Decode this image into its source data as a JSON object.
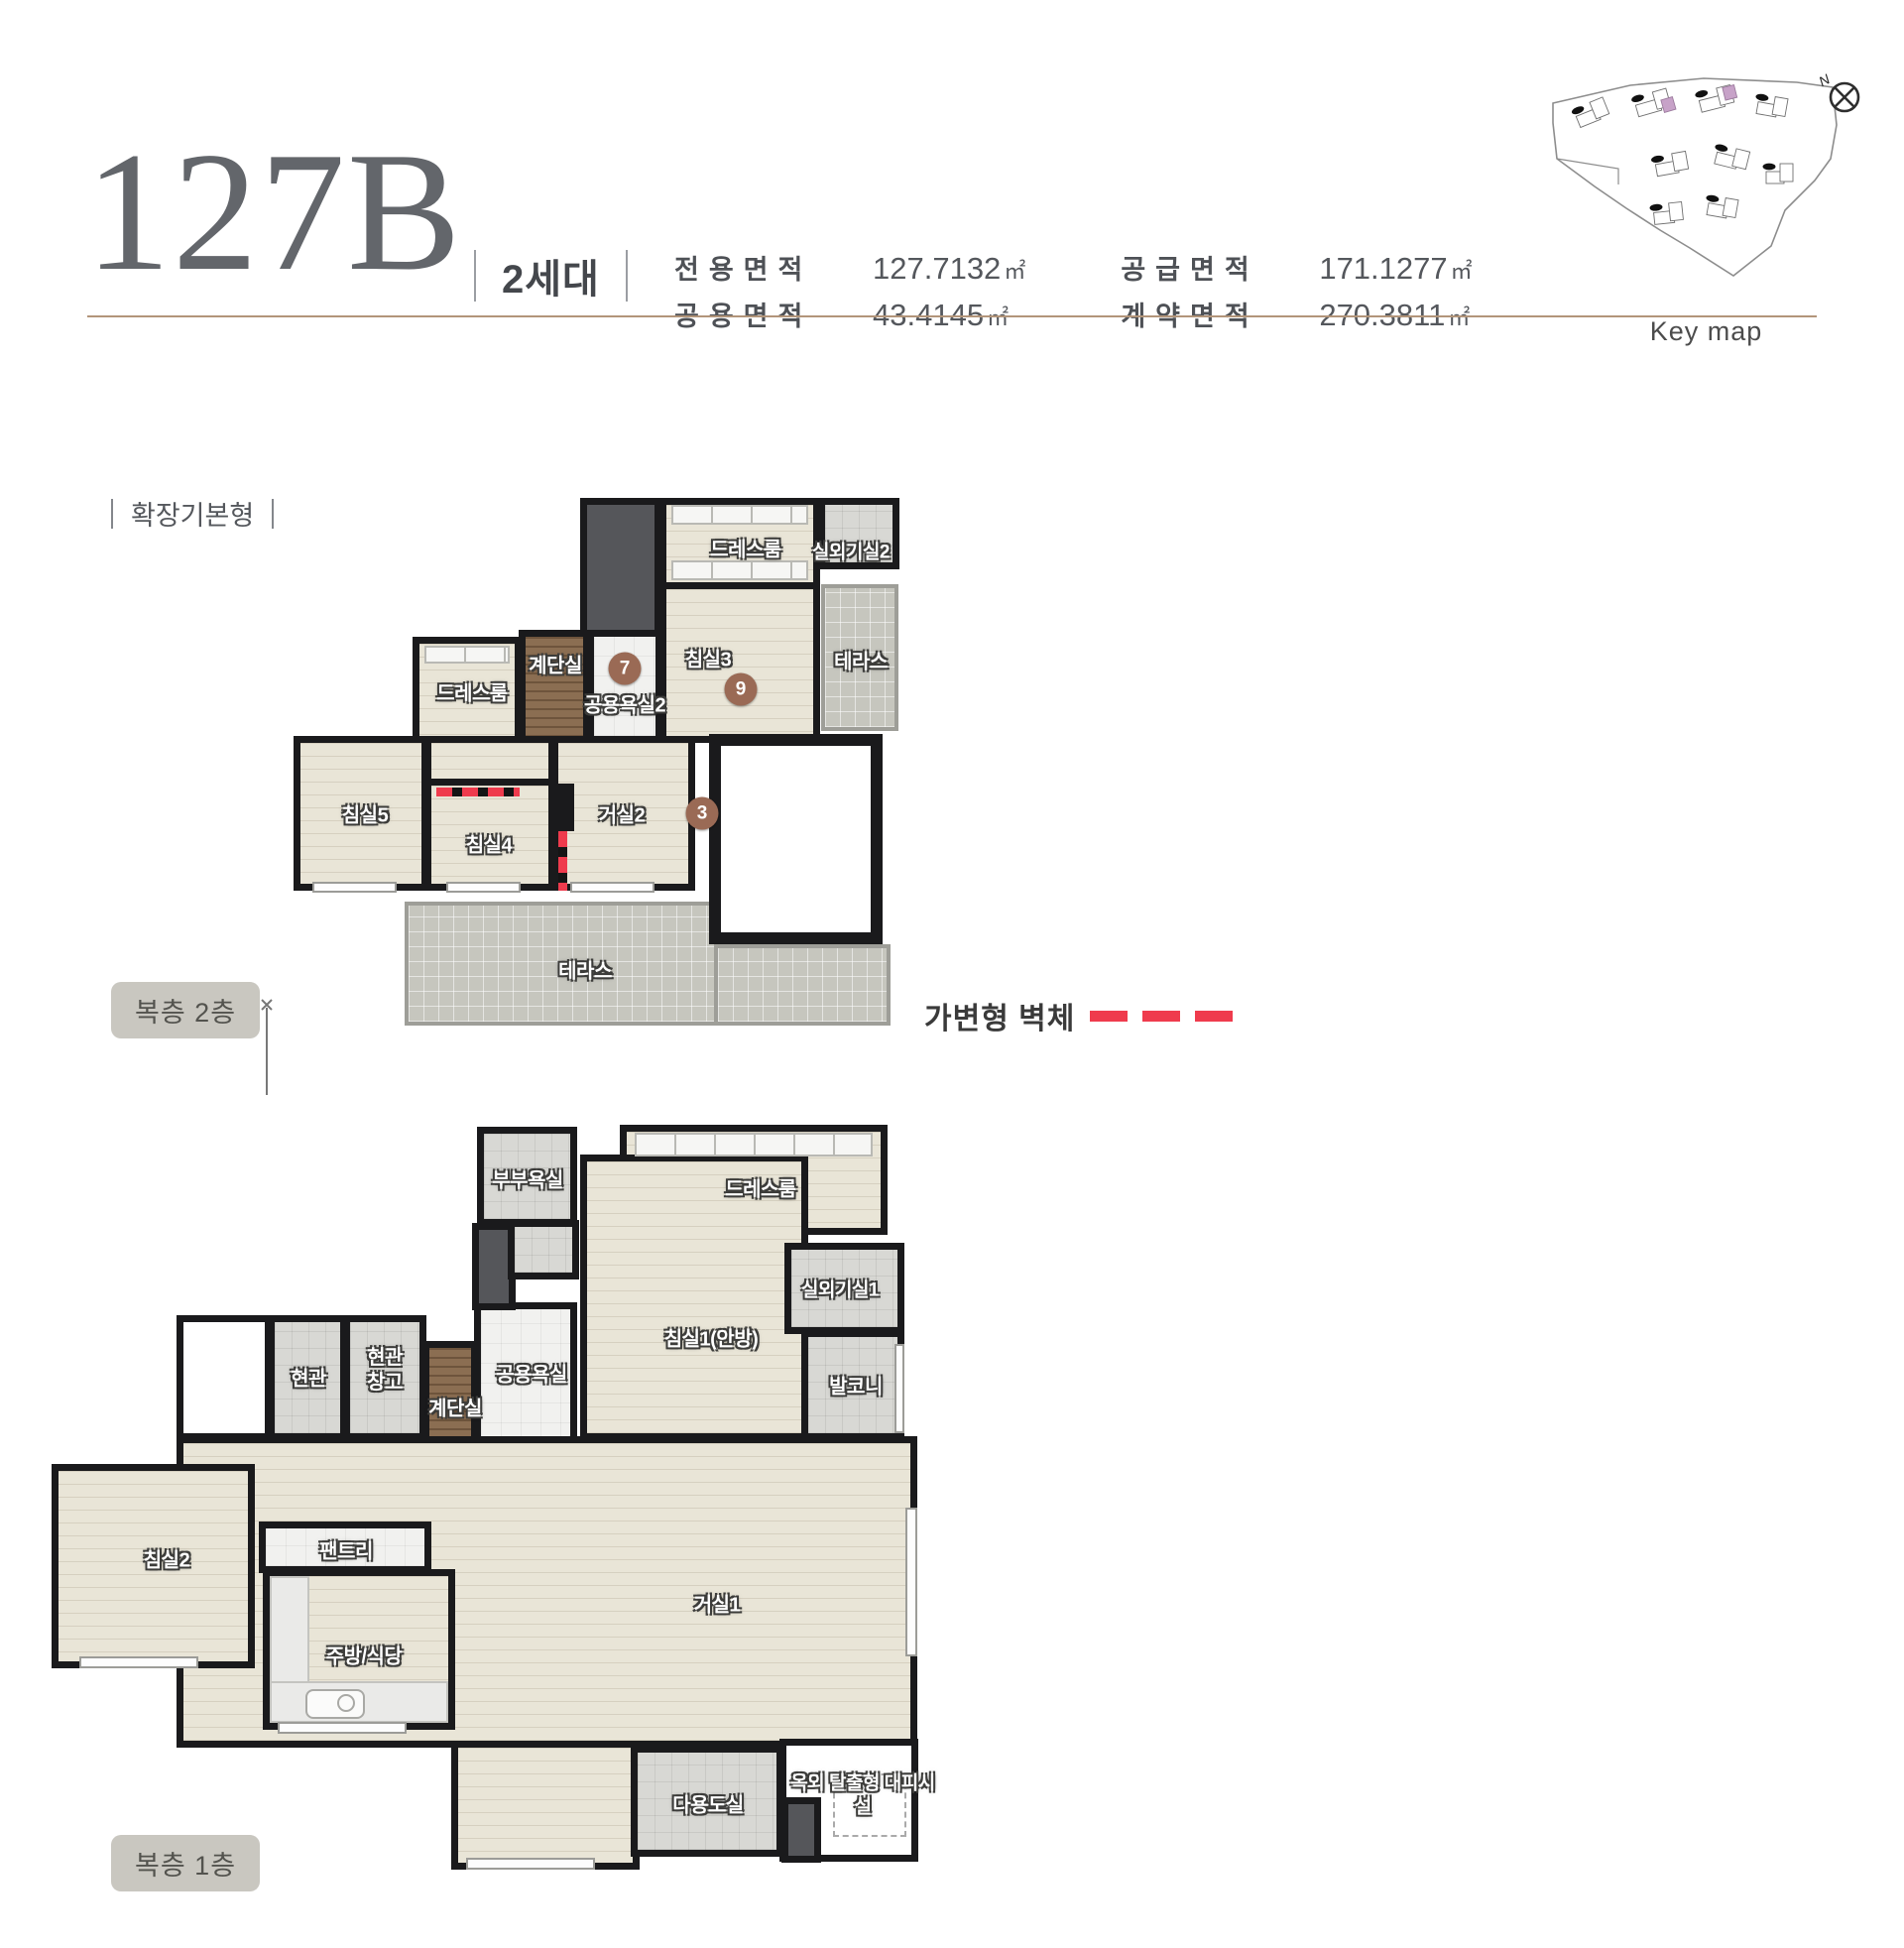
{
  "header": {
    "unit_code": "127B",
    "household_label": "2세대",
    "area_specs": [
      {
        "label": "전용면적",
        "value": "127.7132",
        "unit": "㎡"
      },
      {
        "label": "공용면적",
        "value": "43.4145",
        "unit": "㎡"
      },
      {
        "label": "공급면적",
        "value": "171.1277",
        "unit": "㎡"
      },
      {
        "label": "계약면적",
        "value": "270.3811",
        "unit": "㎡"
      }
    ],
    "keymap": {
      "caption": "Key map",
      "compass_n": "N"
    }
  },
  "section": {
    "plan_type_label": "확장기본형"
  },
  "legend": {
    "movable_wall_label": "가변형 벽체"
  },
  "colors": {
    "accent_line": "#b2957a",
    "movable_wall_red": "#ef3b4d",
    "marker_brown": "#9a6a55",
    "keymap_highlight": "#c7a2c8"
  },
  "floor2": {
    "badge": "복층 2층",
    "rooms": {
      "dressroom_top": "드레스룸",
      "outdoor_unit2": "실외기실2",
      "terrace_right": "테라스",
      "stairwell": "계단실",
      "shared_bath2": "공용욕실2",
      "bedroom3": "침실3",
      "dressroom_left": "드레스룸",
      "bedroom5": "침실5",
      "bedroom4": "침실4",
      "living2": "거실2",
      "terrace_bottom": "테라스"
    },
    "markers": {
      "shared_bath2": "7",
      "bedroom3": "9",
      "living2": "3"
    }
  },
  "floor1": {
    "badge": "복층 1층",
    "rooms": {
      "master_bath": "부부욕실",
      "dressroom": "드레스룸",
      "bedroom1": "침실1(안방)",
      "outdoor_unit1": "실외기실1",
      "balcony": "발코니",
      "entrance": "현관",
      "entrance_storage": "현관창고",
      "stairwell": "계단실",
      "shared_bath": "공용욕실",
      "bedroom2": "침실2",
      "pantry": "팬트리",
      "kitchen_dining": "주방/식당",
      "living1": "거실1",
      "utility": "다용도실",
      "evacuation": "옥외 탈출형 대피시설"
    }
  }
}
